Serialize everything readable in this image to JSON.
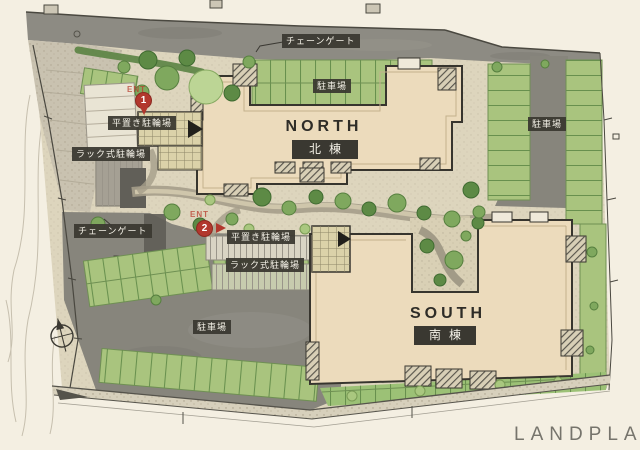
{
  "page": {
    "plan_label": "LANDPLAN"
  },
  "buildings": {
    "north": {
      "en": "NORTH",
      "jp": "北棟"
    },
    "south": {
      "en": "SOUTH",
      "jp": "南棟"
    }
  },
  "labels": {
    "chain_gate_top": "チェーンゲート",
    "chain_gate_left": "チェーンゲート",
    "parking_top": "駐車場",
    "parking_right": "駐車場",
    "parking_bottom": "駐車場",
    "bicycle_flat_top": "平置き駐輪場",
    "bicycle_rack_top": "ラック式駐輪場",
    "bicycle_flat_center": "平置き駐輪場",
    "bicycle_rack_center": "ラック式駐輪場"
  },
  "markers": {
    "m1": {
      "num": "1",
      "note": "ENT"
    },
    "m2": {
      "num": "2",
      "note": "ENT"
    }
  },
  "colors": {
    "paper": "#f4efe2",
    "road": "#8d8b83",
    "building": "#ecdbbc",
    "parking_green": "#a9c47e",
    "label_bg": "#3a3831",
    "marker_red": "#b2372d",
    "watermark": "#76746c"
  }
}
